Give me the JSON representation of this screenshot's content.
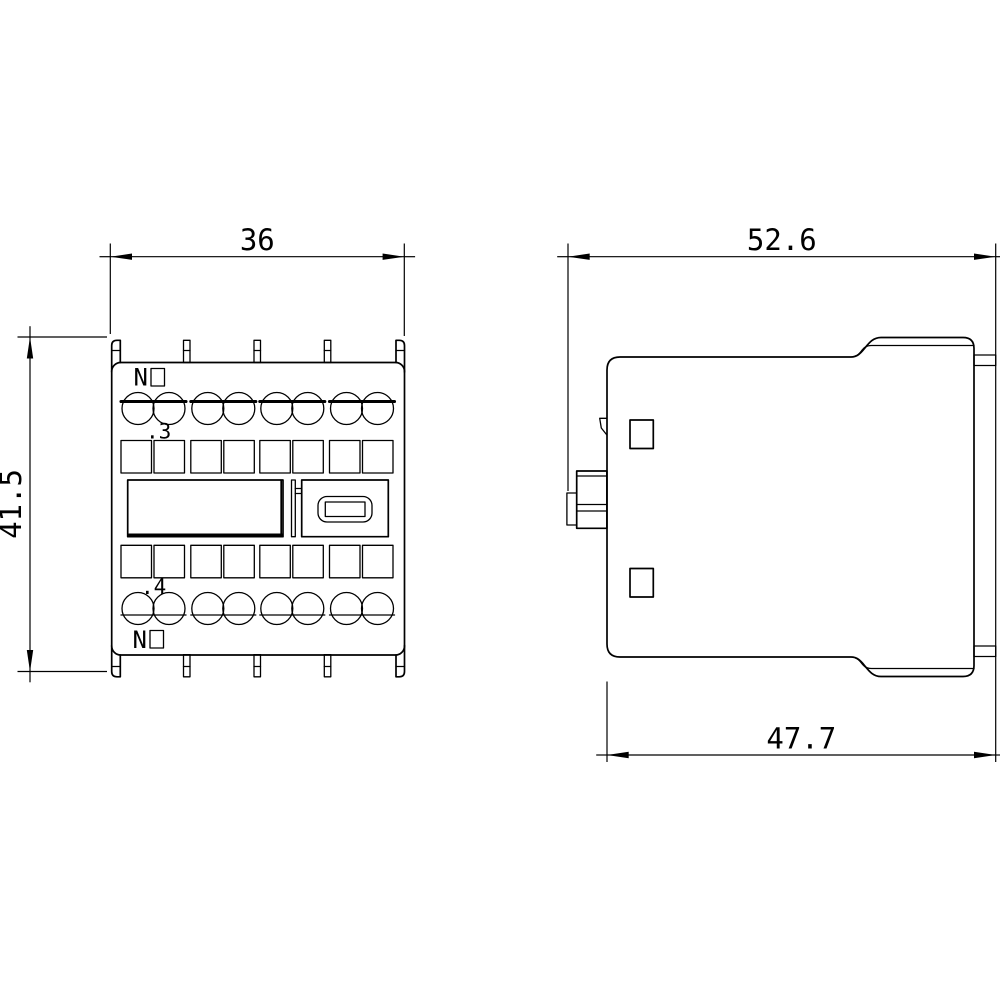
{
  "colors": {
    "line": "#000000",
    "background": "#ffffff"
  },
  "front_view": {
    "dim_width": "36",
    "dim_height": "41.5",
    "no_label_top": "N",
    "terminal_label_top": ".3",
    "terminal_label_bottom": ".4",
    "no_label_bottom": "N"
  },
  "side_view": {
    "dim_overall_width": "52.6",
    "dim_body_depth": "47.7"
  }
}
